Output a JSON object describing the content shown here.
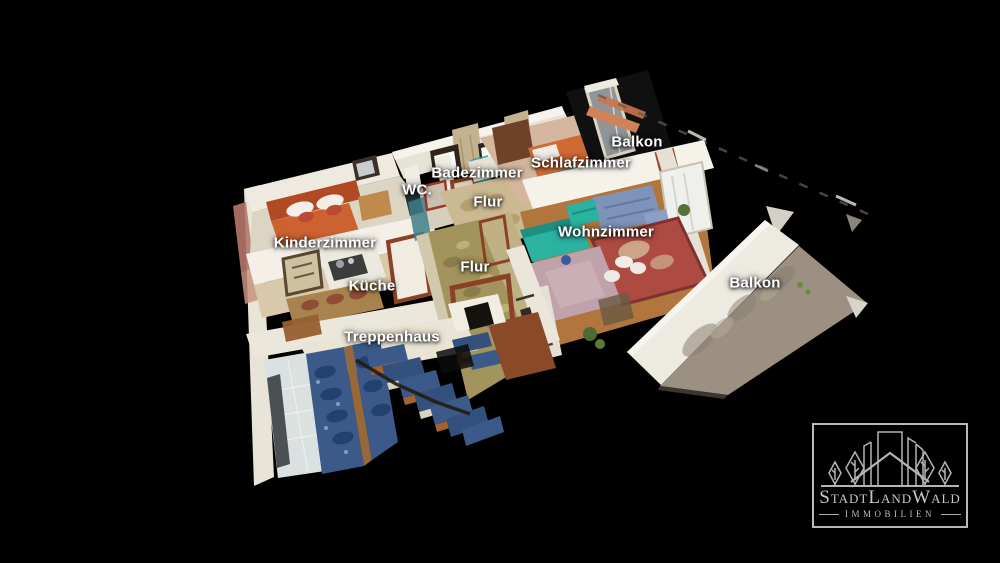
{
  "view": {
    "type": "3d-dollhouse-floorplan",
    "background": "#000000"
  },
  "rooms": [
    {
      "id": "balkon-top",
      "label": "Balkon",
      "x": 637,
      "y": 142
    },
    {
      "id": "schlafzimmer",
      "label": "Schlafzimmer",
      "x": 581,
      "y": 163
    },
    {
      "id": "badezimmer",
      "label": "Badezimmer",
      "x": 477,
      "y": 173
    },
    {
      "id": "wc",
      "label": "WC.",
      "x": 417,
      "y": 190
    },
    {
      "id": "flur-top",
      "label": "Flur",
      "x": 488,
      "y": 202
    },
    {
      "id": "wohnzimmer",
      "label": "Wohnzimmer",
      "x": 606,
      "y": 232
    },
    {
      "id": "kinderzimmer",
      "label": "Kinderzimmer",
      "x": 325,
      "y": 243
    },
    {
      "id": "flur",
      "label": "Flur",
      "x": 475,
      "y": 267
    },
    {
      "id": "kueche",
      "label": "Küche",
      "x": 372,
      "y": 286
    },
    {
      "id": "balkon",
      "label": "Balkon",
      "x": 755,
      "y": 283
    },
    {
      "id": "treppenhaus",
      "label": "Treppenhaus",
      "x": 392,
      "y": 337
    }
  ],
  "watermark": {
    "brand": "StadtLandWald",
    "subtitle": "IMMOBILIEN"
  },
  "colors": {
    "label_text": "#ffffff",
    "logo": "#bdbdbd",
    "background": "#000000"
  }
}
